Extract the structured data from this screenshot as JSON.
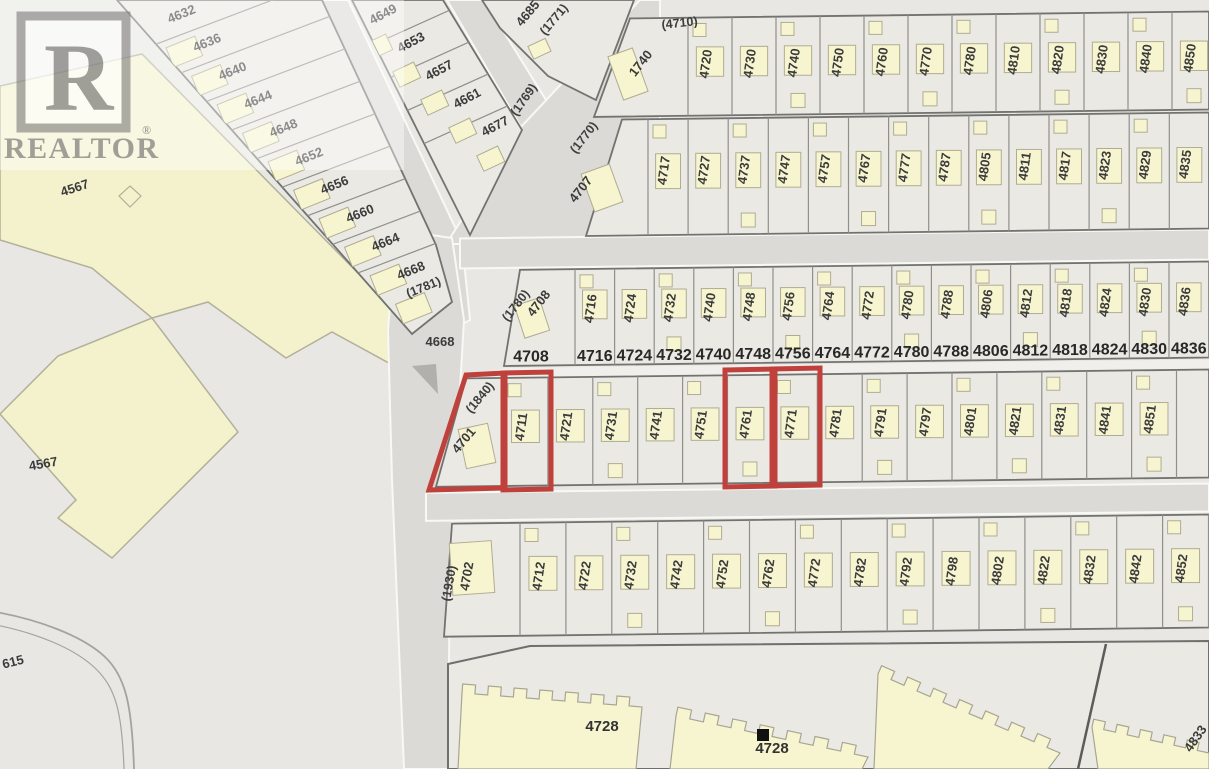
{
  "map": {
    "streets": {
      "brentlawn": "BRENTLAWN DR",
      "ridgelawn": "RIDGELAWN DR"
    },
    "watermark": {
      "brand": "REALTOR",
      "reg": "®",
      "initial": "R"
    },
    "rows": {
      "A": {
        "plan": "(4710)",
        "first": "1740",
        "lots": [
          "4720",
          "4730",
          "4740",
          "4750",
          "4760",
          "4770",
          "4780",
          "4810",
          "4820",
          "4830",
          "4840",
          "4850"
        ]
      },
      "B": {
        "plan": "(1770)",
        "first": "4707",
        "lots": [
          "4717",
          "4727",
          "4737",
          "4747",
          "4757",
          "4767",
          "4777",
          "4787",
          "4805",
          "4811",
          "4817",
          "4823",
          "4829",
          "4835"
        ]
      },
      "C": {
        "plan": "(1780)",
        "first": "4708",
        "lots": [
          "4716",
          "4724",
          "4732",
          "4740",
          "4748",
          "4756",
          "4764",
          "4772",
          "4780",
          "4788",
          "4806",
          "4812",
          "4818",
          "4824",
          "4830",
          "4836"
        ],
        "strip": [
          "4708",
          "4716",
          "4724",
          "4732",
          "4740",
          "4748",
          "4756",
          "4764",
          "4772",
          "4780",
          "4788",
          "4806",
          "4812",
          "4818",
          "4824",
          "4830",
          "4836"
        ]
      },
      "D": {
        "plan": "(1840)",
        "first": "4701",
        "lots": [
          "4711",
          "4721",
          "4731",
          "4741",
          "4751",
          "4761",
          "4771",
          "4781",
          "4791",
          "4797",
          "4801",
          "4821",
          "4831",
          "4841",
          "4851"
        ],
        "highlighted": [
          "4701",
          "4711",
          "4761",
          "4771"
        ]
      },
      "E": {
        "plan": "(1930)",
        "first": "4702",
        "lots": [
          "4712",
          "4722",
          "4732",
          "4742",
          "4752",
          "4762",
          "4772",
          "4782",
          "4792",
          "4798",
          "4802",
          "4822",
          "4832",
          "4842",
          "4852"
        ]
      }
    },
    "diagonal": {
      "west": {
        "lots": [
          "4632",
          "4636",
          "4640",
          "4644",
          "4648",
          "4652",
          "4656",
          "4660",
          "4664",
          "4668"
        ],
        "plan": "(1781)",
        "corner": "4668"
      },
      "middle": {
        "lots": [
          "4649",
          "4653",
          "4657",
          "4661",
          "4677"
        ],
        "plan": "(1769)"
      },
      "sliver": {
        "lots": [
          "4685"
        ],
        "plan": "(1771)"
      }
    },
    "park": {
      "labels": [
        "4567",
        "4567"
      ]
    },
    "misc": {
      "bottom_left": "615"
    },
    "buildings": [
      "4728",
      "4728",
      "4833"
    ],
    "colors": {
      "highlight": "#c0403c",
      "building": "#f7f5d0",
      "park": "#f4f2cd",
      "road": "#dbdad6",
      "block": "#eae9e4"
    }
  }
}
